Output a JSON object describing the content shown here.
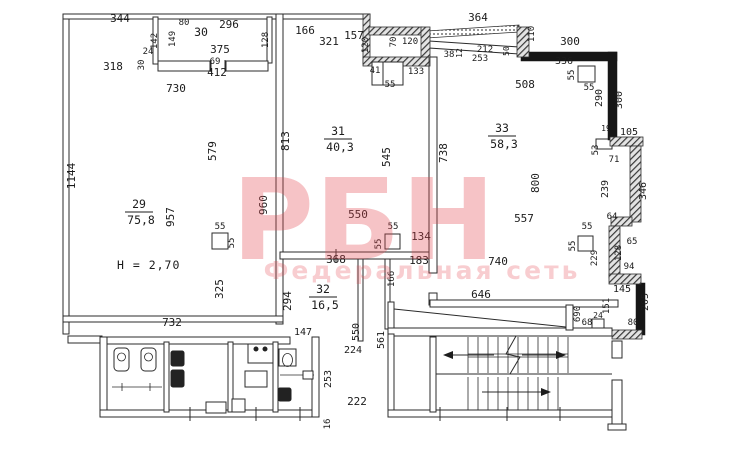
{
  "document": {
    "type": "floor-plan-scan",
    "height_note": "H = 2,70",
    "accent_color": "#e4484e",
    "line_color": "#2b2b2b"
  },
  "watermark": {
    "logo": "РБН",
    "subtitle": "Федеральная сеть"
  },
  "rooms": [
    {
      "number": "29",
      "area": "75,8",
      "x": 139,
      "y": 212
    },
    {
      "number": "30",
      "area": "",
      "x": 201,
      "y": 40
    },
    {
      "number": "31",
      "area": "40,3",
      "x": 338,
      "y": 139
    },
    {
      "number": "32",
      "area": "16,5",
      "x": 323,
      "y": 297
    },
    {
      "number": "33",
      "area": "58,3",
      "x": 502,
      "y": 136
    }
  ],
  "labels": [
    {
      "t": "344",
      "x": 120,
      "y": 22
    },
    {
      "t": "318",
      "x": 113,
      "y": 70
    },
    {
      "t": "730",
      "x": 176,
      "y": 92
    },
    {
      "t": "1144",
      "x": 75,
      "y": 176,
      "v": 1
    },
    {
      "t": "142",
      "x": 157,
      "y": 41,
      "v": 1,
      "s": 9
    },
    {
      "t": "24",
      "x": 148,
      "y": 54,
      "s": 9
    },
    {
      "t": "30",
      "x": 144,
      "y": 65,
      "v": 1,
      "s": 9
    },
    {
      "t": "80",
      "x": 184,
      "y": 25,
      "s": 9
    },
    {
      "t": "149",
      "x": 175,
      "y": 39,
      "v": 1,
      "s": 9
    },
    {
      "t": "296",
      "x": 229,
      "y": 28
    },
    {
      "t": "375",
      "x": 220,
      "y": 53
    },
    {
      "t": "69",
      "x": 215,
      "y": 64,
      "s": 9
    },
    {
      "t": "412",
      "x": 217,
      "y": 76
    },
    {
      "t": "128",
      "x": 268,
      "y": 40,
      "v": 1,
      "s": 9
    },
    {
      "t": "579",
      "x": 216,
      "y": 151,
      "v": 1
    },
    {
      "t": "957",
      "x": 174,
      "y": 217,
      "v": 1
    },
    {
      "t": "960",
      "x": 267,
      "y": 205,
      "v": 1
    },
    {
      "t": "325",
      "x": 223,
      "y": 289,
      "v": 1
    },
    {
      "t": "732",
      "x": 172,
      "y": 326
    },
    {
      "t": "55",
      "x": 220,
      "y": 229,
      "s": 9
    },
    {
      "t": "55",
      "x": 234,
      "y": 243,
      "v": 1,
      "s": 9
    },
    {
      "t": "166",
      "x": 305,
      "y": 34
    },
    {
      "t": "321",
      "x": 329,
      "y": 45
    },
    {
      "t": "157",
      "x": 354,
      "y": 39
    },
    {
      "t": "120",
      "x": 368,
      "y": 45,
      "v": 1,
      "s": 9
    },
    {
      "t": "70",
      "x": 396,
      "y": 42,
      "v": 1,
      "s": 9
    },
    {
      "t": "120",
      "x": 410,
      "y": 44,
      "s": 9
    },
    {
      "t": "364",
      "x": 478,
      "y": 21
    },
    {
      "t": "38",
      "x": 449,
      "y": 57,
      "s": 9
    },
    {
      "t": "12",
      "x": 462,
      "y": 53,
      "v": 1,
      "s": 8
    },
    {
      "t": "212",
      "x": 485,
      "y": 52,
      "s": 9
    },
    {
      "t": "253",
      "x": 480,
      "y": 61,
      "s": 9
    },
    {
      "t": "50",
      "x": 509,
      "y": 51,
      "v": 1,
      "s": 8
    },
    {
      "t": "41",
      "x": 375,
      "y": 73,
      "s": 9
    },
    {
      "t": "133",
      "x": 416,
      "y": 74,
      "s": 9
    },
    {
      "t": "55",
      "x": 390,
      "y": 87,
      "s": 9
    },
    {
      "t": "110",
      "x": 534,
      "y": 34,
      "v": 1,
      "s": 9
    },
    {
      "t": "300",
      "x": 570,
      "y": 45
    },
    {
      "t": "336",
      "x": 564,
      "y": 64,
      "s": 10
    },
    {
      "t": "55",
      "x": 574,
      "y": 75,
      "v": 1,
      "s": 9
    },
    {
      "t": "55",
      "x": 589,
      "y": 90,
      "s": 9
    },
    {
      "t": "290",
      "x": 602,
      "y": 98,
      "v": 1,
      "s": 10
    },
    {
      "t": "300",
      "x": 622,
      "y": 100,
      "v": 1,
      "s": 10
    },
    {
      "t": "508",
      "x": 525,
      "y": 88
    },
    {
      "t": "813",
      "x": 289,
      "y": 141,
      "v": 1
    },
    {
      "t": "545",
      "x": 390,
      "y": 157,
      "v": 1
    },
    {
      "t": "738",
      "x": 447,
      "y": 153,
      "v": 1
    },
    {
      "t": "800",
      "x": 539,
      "y": 183,
      "v": 1
    },
    {
      "t": "550",
      "x": 358,
      "y": 218
    },
    {
      "t": "55",
      "x": 393,
      "y": 229,
      "s": 9
    },
    {
      "t": "55",
      "x": 381,
      "y": 244,
      "v": 1,
      "s": 9
    },
    {
      "t": "134",
      "x": 421,
      "y": 240
    },
    {
      "t": "557",
      "x": 524,
      "y": 222
    },
    {
      "t": "740",
      "x": 498,
      "y": 265
    },
    {
      "t": "19",
      "x": 606,
      "y": 131,
      "s": 8
    },
    {
      "t": "105",
      "x": 629,
      "y": 135,
      "s": 10
    },
    {
      "t": "53",
      "x": 598,
      "y": 150,
      "v": 1,
      "s": 9
    },
    {
      "t": "71",
      "x": 614,
      "y": 162,
      "s": 9
    },
    {
      "t": "239",
      "x": 608,
      "y": 189,
      "v": 1,
      "s": 10
    },
    {
      "t": "346",
      "x": 646,
      "y": 191,
      "v": 1,
      "s": 10
    },
    {
      "t": "64",
      "x": 612,
      "y": 219,
      "s": 9
    },
    {
      "t": "55",
      "x": 587,
      "y": 229,
      "s": 9
    },
    {
      "t": "55",
      "x": 575,
      "y": 246,
      "v": 1,
      "s": 9
    },
    {
      "t": "229",
      "x": 597,
      "y": 258,
      "v": 1,
      "s": 9
    },
    {
      "t": "65",
      "x": 632,
      "y": 244,
      "s": 9
    },
    {
      "t": "128",
      "x": 621,
      "y": 253,
      "v": 1,
      "s": 9
    },
    {
      "t": "94",
      "x": 629,
      "y": 269,
      "s": 9
    },
    {
      "t": "145",
      "x": 622,
      "y": 292,
      "s": 10
    },
    {
      "t": "151",
      "x": 609,
      "y": 306,
      "v": 1,
      "s": 9
    },
    {
      "t": "205",
      "x": 648,
      "y": 302,
      "v": 1,
      "s": 10
    },
    {
      "t": "690",
      "x": 580,
      "y": 314,
      "v": 1,
      "s": 9
    },
    {
      "t": "24",
      "x": 598,
      "y": 318,
      "s": 8
    },
    {
      "t": "68",
      "x": 587,
      "y": 325,
      "s": 9
    },
    {
      "t": "80",
      "x": 633,
      "y": 325,
      "s": 9
    },
    {
      "t": "368",
      "x": 336,
      "y": 263
    },
    {
      "t": "183",
      "x": 419,
      "y": 264
    },
    {
      "t": "166",
      "x": 394,
      "y": 279,
      "v": 1,
      "s": 9
    },
    {
      "t": "294",
      "x": 291,
      "y": 301,
      "v": 1
    },
    {
      "t": "147",
      "x": 303,
      "y": 335,
      "s": 10
    },
    {
      "t": "550",
      "x": 359,
      "y": 332,
      "v": 1,
      "s": 10
    },
    {
      "t": "224",
      "x": 353,
      "y": 353,
      "s": 10
    },
    {
      "t": "561",
      "x": 384,
      "y": 340,
      "v": 1,
      "s": 10
    },
    {
      "t": "222",
      "x": 357,
      "y": 405
    },
    {
      "t": "646",
      "x": 481,
      "y": 298
    },
    {
      "t": "253",
      "x": 331,
      "y": 379,
      "v": 1,
      "s": 10
    },
    {
      "t": "16",
      "x": 330,
      "y": 424,
      "v": 1,
      "s": 9
    }
  ]
}
